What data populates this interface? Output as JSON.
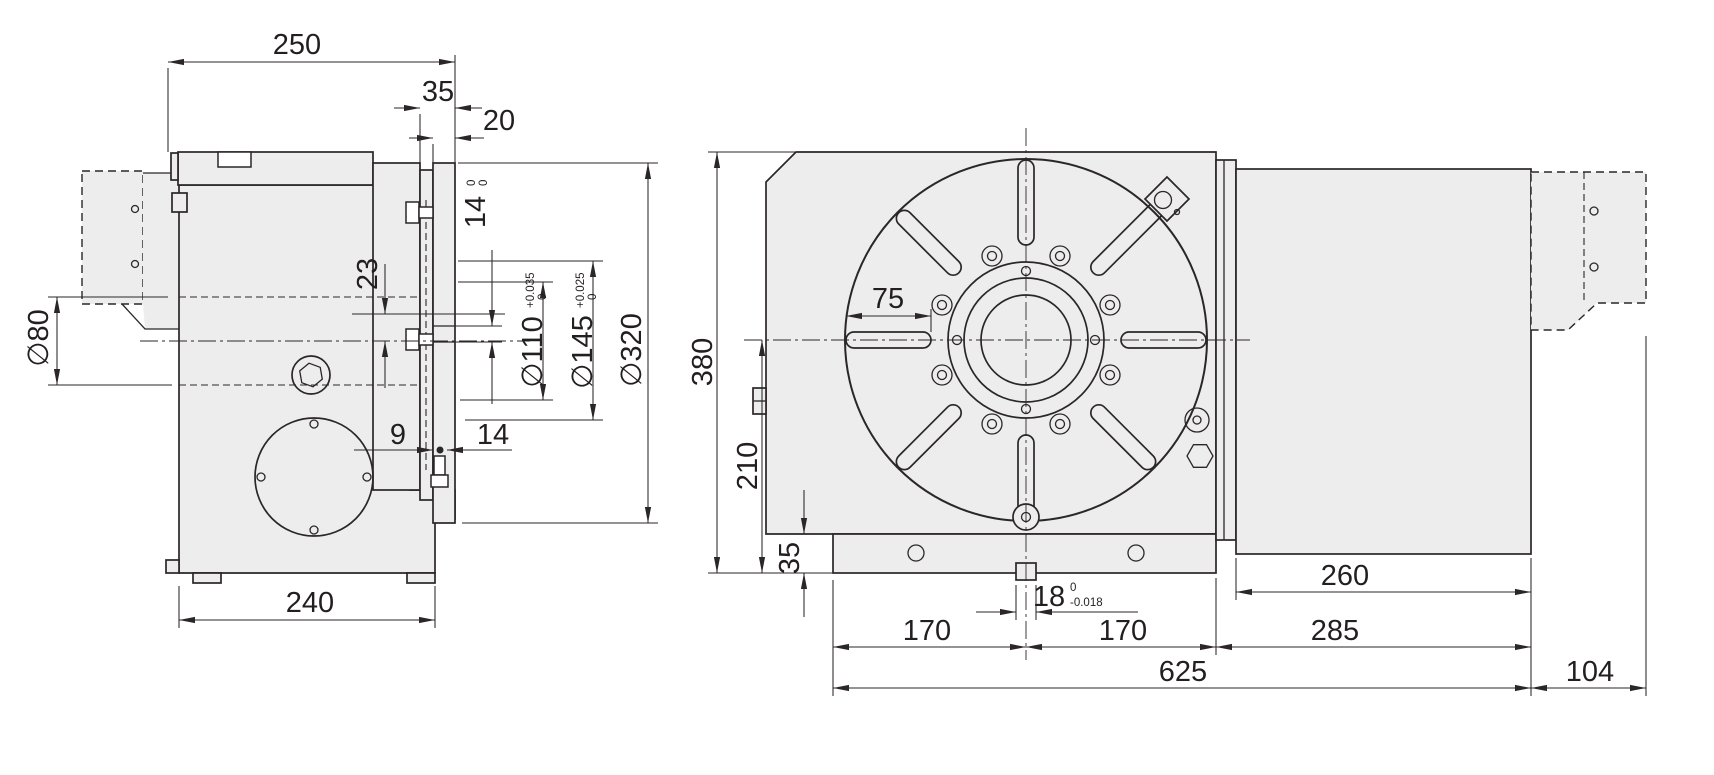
{
  "drawing": {
    "left_view": {
      "width_top": "250",
      "flange_depth": "35",
      "faceplate_thickness": "20",
      "slot_width": {
        "value": "14",
        "tol_upper": "0",
        "tol_lower": "0"
      },
      "key_offset": "23",
      "shaft_dia": "∅80",
      "spigot_dia": {
        "value": "∅110",
        "tol_upper": "+0.035",
        "tol_lower": "0"
      },
      "pilot_dia": {
        "value": "∅145",
        "tol_upper": "+0.025",
        "tol_lower": "0"
      },
      "faceplate_dia": "∅320",
      "bolt_offset": "9",
      "bolt_depth": "14",
      "base_width": "240"
    },
    "right_view": {
      "body_height": "380",
      "center_height": "210",
      "base_height": "35",
      "slot_length": "75",
      "key_width": {
        "value": "18",
        "tol_upper": "0",
        "tol_lower": "-0.018"
      },
      "center_to_left": "170",
      "center_to_right": "170",
      "motor_length": "260",
      "motor_section": "285",
      "overall_length": "625",
      "tail_length": "104"
    }
  }
}
